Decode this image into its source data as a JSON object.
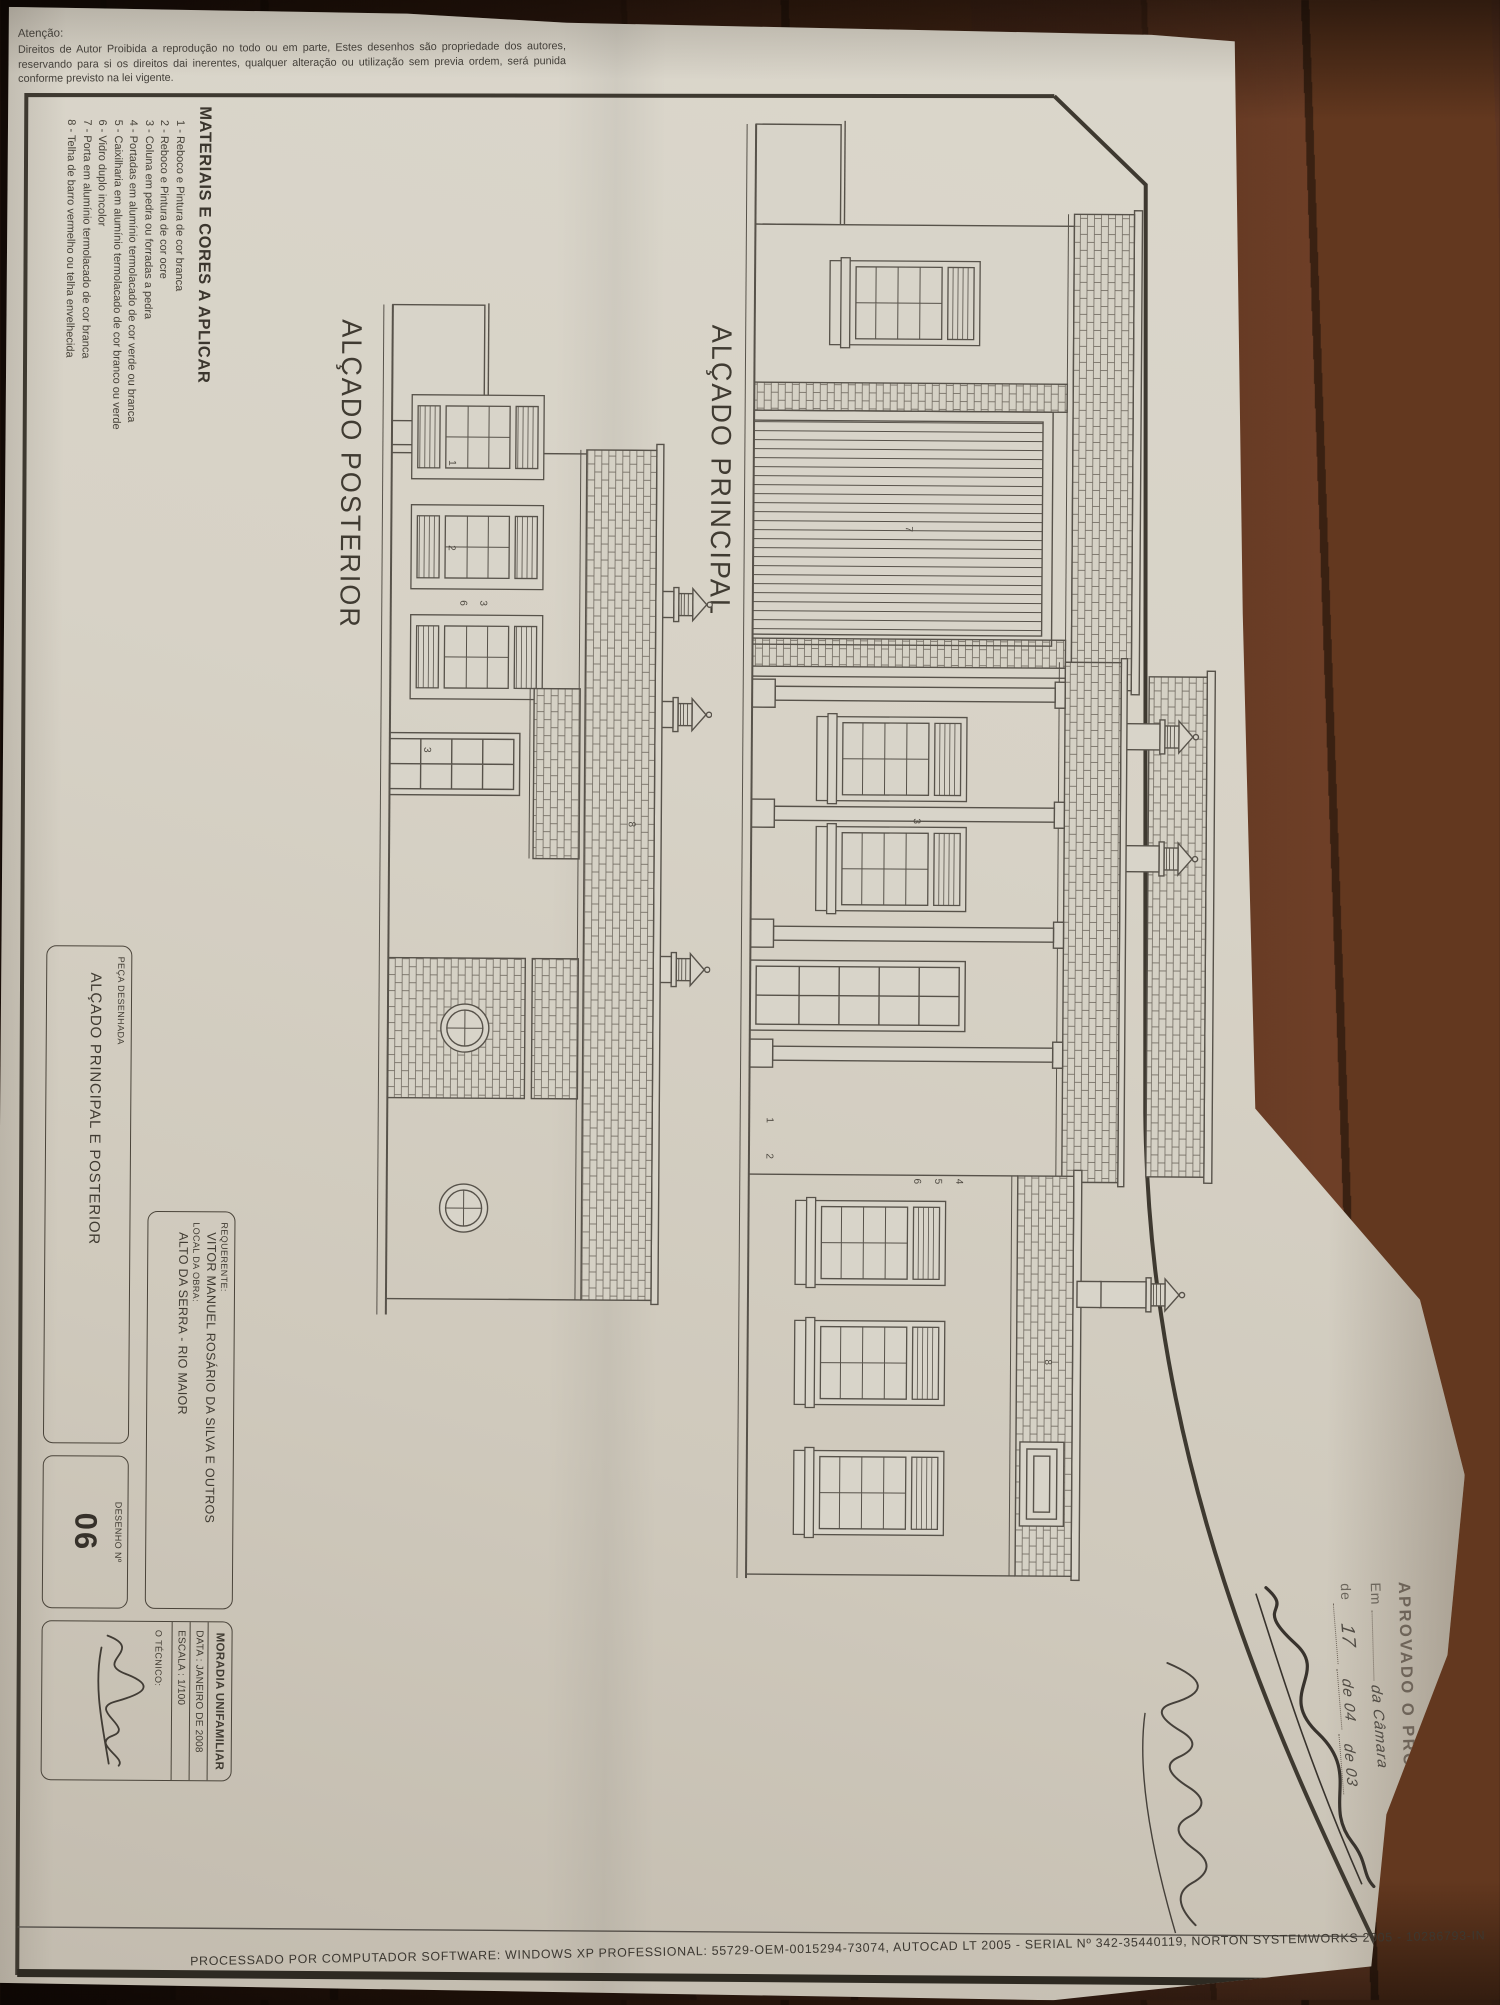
{
  "margin_notes": {
    "attention_title": "Atenção:",
    "attention_body": "Direitos de Autor Proibida a reprodução no todo ou em parte, Estes desenhos são propriedade dos autores, reservando para si os direitos dai inerentes, qualquer alteração ou utilização sem previa ordem, será punida conforme previsto na lei vigente.",
    "processing_note": "PROCESSADO POR COMPUTADOR SOFTWARE: WINDOWS XP PROFESSIONAL: 55729-OEM-0015294-73074, AUTOCAD LT 2005 - SERIAL Nº 342-35440119, NORTON SYSTEMWORKS 2005 - 10286793-IN"
  },
  "legend": {
    "title": "MATERIAIS E CORES A APLICAR",
    "items": [
      "1 - Reboco e Pintura de cor branca",
      "2 - Reboco e Pintura de cor ocre",
      "3 - Coluna em pedra ou forradas a pedra",
      "4 - Portadas em alumínio termolacado de cor verde ou branca",
      "5 - Caixilharia em alumínio termolacado de cor branco ou verde",
      "6 - Vidro duplo incolor",
      "7 - Porta em alumínio termolacado de cor branca",
      "8 - Telha de barro vermelho ou telha envelhecida"
    ]
  },
  "elevations": [
    {
      "label": "ALÇADO PRINCIPAL",
      "markers": [
        {
          "n": "8",
          "x": 1240,
          "y": 165
        },
        {
          "n": "7",
          "x": 408,
          "y": 310
        },
        {
          "n": "3",
          "x": 700,
          "y": 300
        },
        {
          "n": "1",
          "x": 1000,
          "y": 445
        },
        {
          "n": "2",
          "x": 1036,
          "y": 445
        },
        {
          "n": "4",
          "x": 1060,
          "y": 255
        },
        {
          "n": "5",
          "x": 1060,
          "y": 276
        },
        {
          "n": "6",
          "x": 1060,
          "y": 297
        }
      ]
    },
    {
      "label": "ALÇADO POSTERIOR",
      "markers": [
        {
          "n": "1",
          "x": 160,
          "y": 262
        },
        {
          "n": "2",
          "x": 245,
          "y": 262
        },
        {
          "n": "3",
          "x": 300,
          "y": 230
        },
        {
          "n": "6",
          "x": 300,
          "y": 250
        },
        {
          "n": "3",
          "x": 447,
          "y": 285
        },
        {
          "n": "8",
          "x": 520,
          "y": 80
        }
      ]
    }
  ],
  "title_block": {
    "requerente_label": "REQUERENTE:",
    "requerente_value": "VITOR MANUEL ROSÁRIO DA SILVA E OUTROS",
    "local_label": "LOCAL DA OBRA:",
    "local_value": "ALTO DA SERRA - RIO MAIOR",
    "peca_label": "PEÇA DESENHADA",
    "peca_value": "ALÇADO PRINCIPAL E POSTERIOR",
    "tipo": "MORADIA UNIFAMILIAR",
    "data": "DATA : JANEIRO DE 2008",
    "escala": "ESCALA : 1/100",
    "tecnico": "O TÉCNICO:",
    "desenho_label": "DESENHO  Nº",
    "desenho_value": "06"
  },
  "stamp": {
    "title": "APROVADO O PROJECTO",
    "line2_prefix": "Em",
    "line2_hand": "da Câmara",
    "line3_prefix": "de",
    "line3_d1": "17",
    "line3_mid": "de 04",
    "line3_end": "de 03"
  }
}
